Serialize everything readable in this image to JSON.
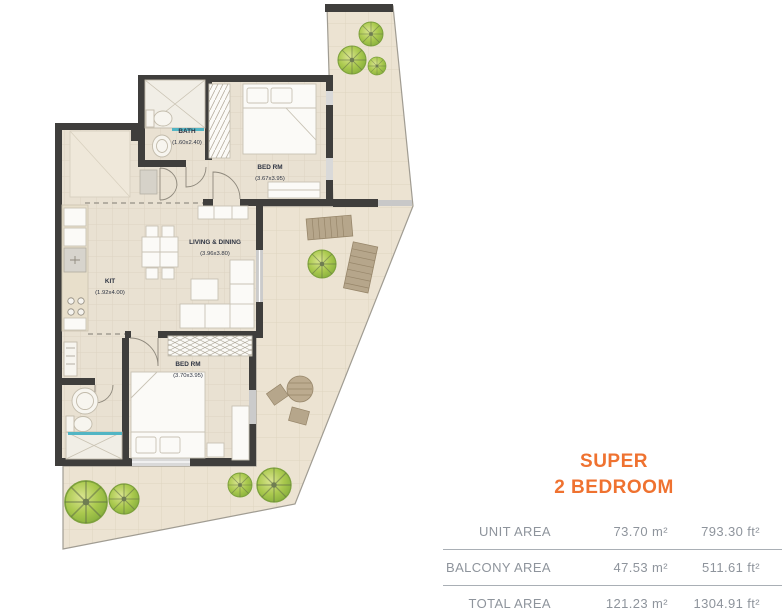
{
  "plan": {
    "rooms": [
      {
        "id": "bath",
        "name": "BATH",
        "dims": "(1.60x2.40)"
      },
      {
        "id": "bed1",
        "name": "BED RM",
        "dims": "(3.67x3.95)"
      },
      {
        "id": "living",
        "name": "LIVING & DINING",
        "dims": "(3.96x3.80)"
      },
      {
        "id": "kit",
        "name": "KIT",
        "dims": "(1.92x4.00)"
      },
      {
        "id": "bed2",
        "name": "BED RM",
        "dims": "(3.70x3.95)"
      }
    ]
  },
  "unit": {
    "title_line1": "SUPER",
    "title_line2": "2 BEDROOM"
  },
  "area_table": {
    "rows": [
      {
        "label": "UNIT AREA",
        "metric": "73.70 m²",
        "imperial": "793.30 ft²"
      },
      {
        "label": "BALCONY AREA",
        "metric": "47.53 m²",
        "imperial": "511.61 ft²"
      },
      {
        "label": "TOTAL AREA",
        "metric": "121.23 m²",
        "imperial": "1304.91 ft²"
      }
    ]
  },
  "colors": {
    "accent_orange": "#EF7230",
    "wall": "#3F3E3C",
    "table_text": "#8E949C",
    "floor": "#EAE2D3"
  }
}
